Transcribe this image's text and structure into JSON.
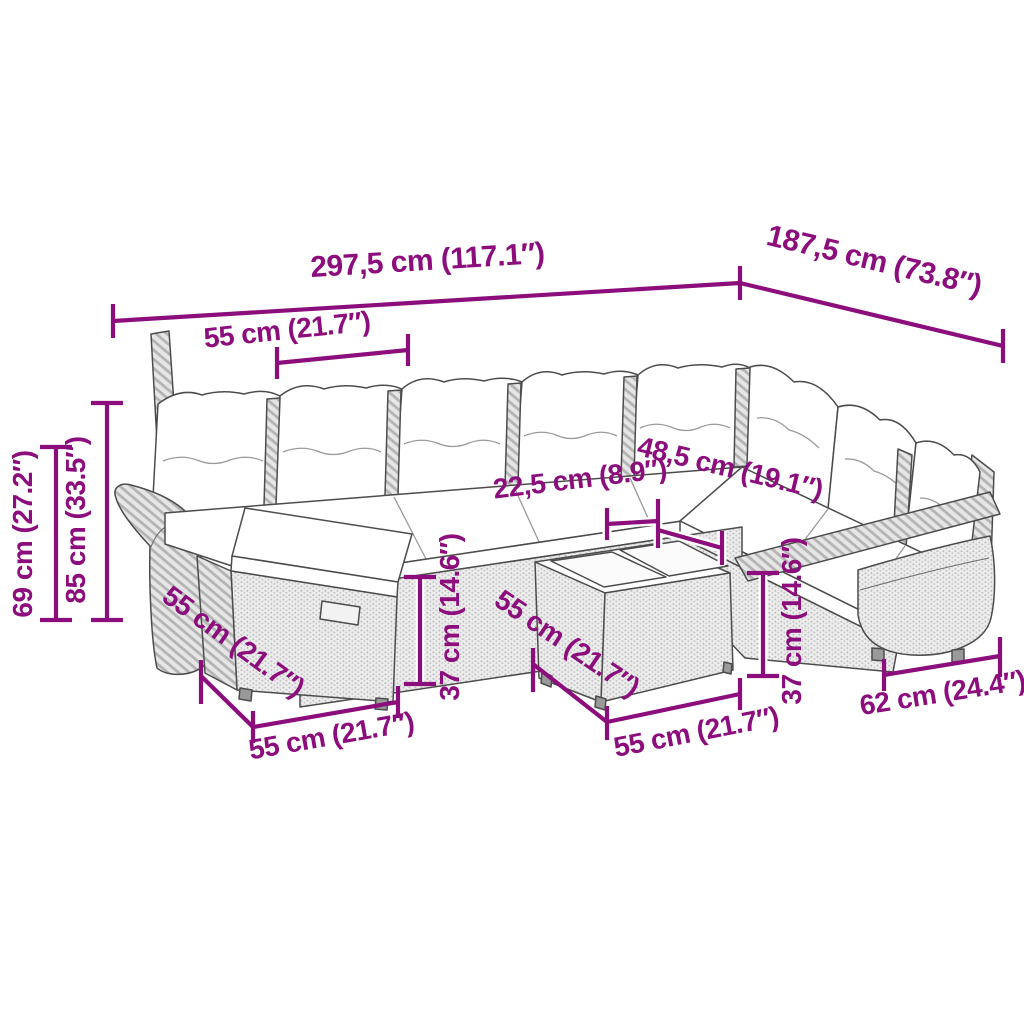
{
  "colors": {
    "dimension": "#8C0D7C",
    "line_art": "#4c4c4c",
    "rattan_light": "#ececec",
    "cushion": "#ffffff"
  },
  "dimensions": {
    "total_width": "297,5 cm (117.1″)",
    "total_depth": "187,5 cm (73.8″)",
    "seat_width": "55 cm (21.7″)",
    "back_height": "69 cm (27.2″)",
    "total_height": "85 cm (33.5″)",
    "tray_width": "22,5 cm (8.9″)",
    "tray_depth": "48,5 cm (19.1″)",
    "stool_height": "37 cm (14.6″)",
    "table_height": "37 cm (14.6″)",
    "stool_depth": "55 cm (21.7″)",
    "stool_width": "55 cm (21.7″)",
    "table_depth": "55 cm (21.7″)",
    "table_width": "55 cm (21.7″)",
    "end_section_depth": "62 cm (24.4″)"
  }
}
